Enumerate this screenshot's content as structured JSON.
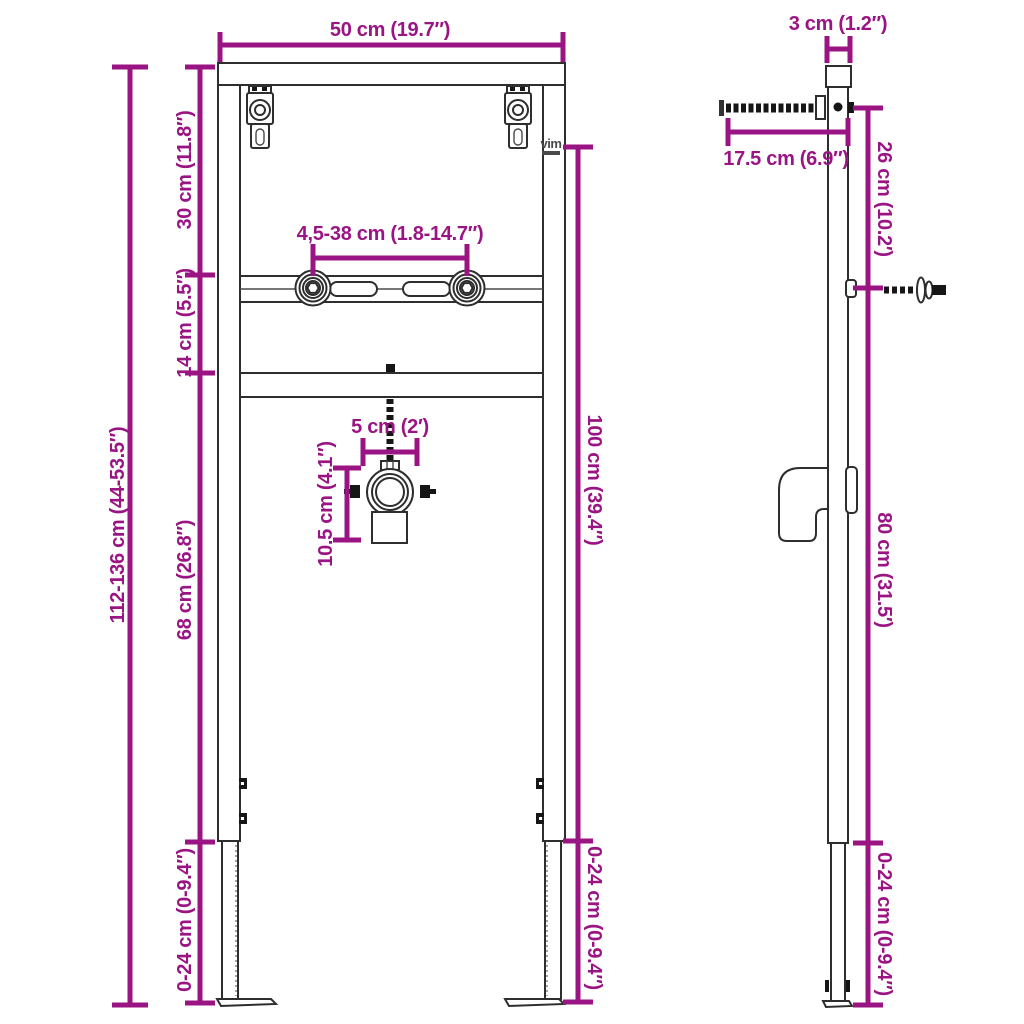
{
  "app": {
    "type": "product-dimension-diagram",
    "subject": "wall-mount basin installation frame, front and side views",
    "background": "#FFFFFF"
  },
  "colors": {
    "dimension_lines": "#9A1583",
    "outline": "#2E2E2E",
    "hardware": "#161616",
    "watermark": "#4A4A4A"
  },
  "watermark": {
    "text": "vim"
  },
  "dimensions": {
    "frame_width": "50 cm (19.7″)",
    "bracket_range": "4,5-38 cm (1.8-14.7″)",
    "drain_offset": "5 cm (2′)",
    "trap_drop": "10.5 cm (4.1″)",
    "top_section": "30 cm (11.8″)",
    "rail_section": "14 cm (5.5″)",
    "lower_section": "68 cm (26.8″)",
    "total_height": "112-136 cm (44-53.5″)",
    "leg_extension_left": "0-24 cm (0-9.4″)",
    "frame_height": "100 cm (39.4″)",
    "leg_extension_front": "0-24 cm (0-9.4″)",
    "frame_depth": "3 cm (1.2″)",
    "anchor_length": "17.5 cm (6.9″)",
    "anchor_drop": "26 cm (10.2′)",
    "outlet_height": "80 cm (31.5′)",
    "leg_extension_side": "0-24 cm (0-9.4″)"
  }
}
